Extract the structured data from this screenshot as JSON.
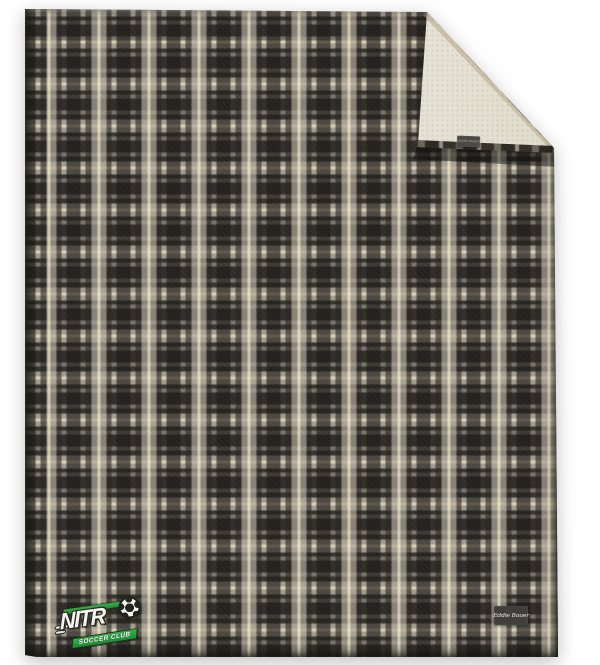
{
  "scene": {
    "description": "Plaid fleece throw blanket product photo, top-right corner folded to show sherpa lining",
    "background_color": "#ffffff"
  },
  "blanket": {
    "front_fabric": "grey ombre plaid fleece",
    "lining": "cream sherpa",
    "colors": {
      "plaid_base": "#7c766e",
      "plaid_dark": "#2e2b26",
      "plaid_light": "#a49d91",
      "plaid_cream": "#e9dfc2",
      "sherpa_cream": "#e0dccd",
      "binding_dark": "#36322b"
    }
  },
  "fold_tag": {
    "text": "EDDIE BAUER",
    "bg": "#4b4a46"
  },
  "brand_label": {
    "text": "Eddie Bauer",
    "bg": "#403f3c",
    "text_color": "#eceae4"
  },
  "logo": {
    "team_letters": "NITR",
    "team_name": "NITRO",
    "wordmark_o": "soccer-ball",
    "banner_text": "SOCCER CLUB",
    "green": "#2a9e41",
    "letter_color": "#f5f4ef",
    "outline_color": "#272a23"
  }
}
